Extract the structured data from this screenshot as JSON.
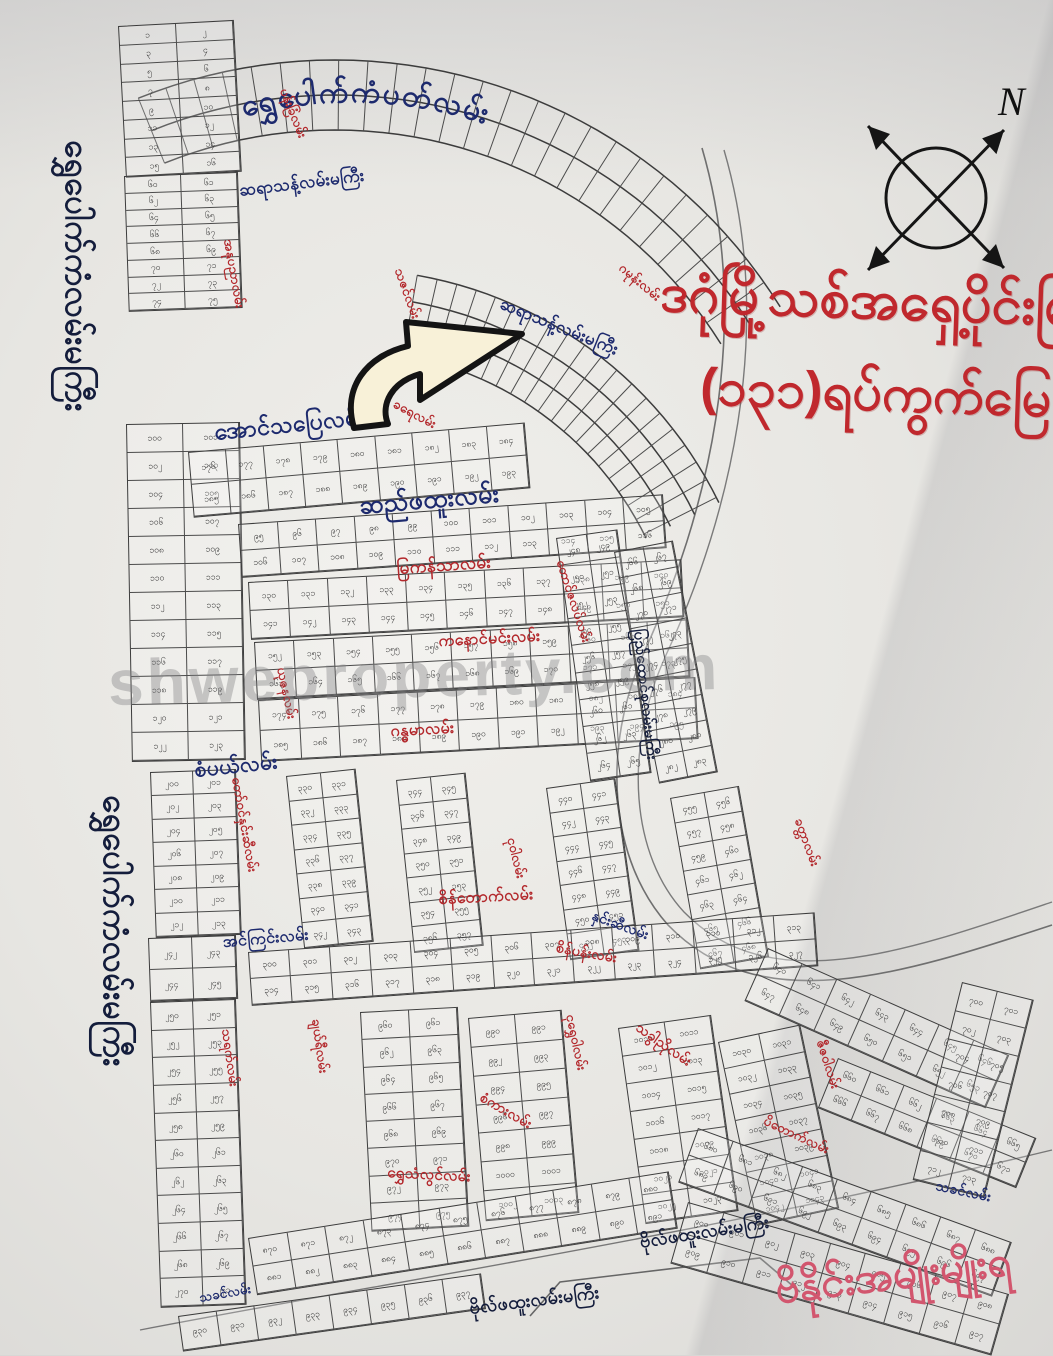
{
  "header": {
    "title_line1": "ဒဂုံမြို့သစ်အရှေ့ပိုင်းမြ",
    "title_line2": "(၁၃၁)ရပ်ကွက်မြေ",
    "compass_label": "N",
    "watermark": "shweproperty.com",
    "bottom_banner": "ဗိနိုင်းအမျိုးမျိုးရ"
  },
  "map": {
    "burmese_digits": "၀၁၂၃၄၅၆၇၈၉",
    "colors": {
      "street_navy": "#1d2a6e",
      "street_red": "#b3282c",
      "main_road_ink": "#141d3c",
      "title_red": "#c0282d",
      "banner_pink": "#d2566e",
      "plot_line": "#3c3c3c",
      "paper": "#efeeea"
    },
    "arc_title": {
      "text": "ရွှေပေါက်ကံပတ်လမ်း"
    },
    "street_labels": [
      {
        "text": "ဆရာသန့်လမ်းမကြီး",
        "x": 238,
        "y": 180,
        "rot": -7,
        "cls": "lbl-navy",
        "size": 17
      },
      {
        "text": "ဆရာသန့်လမ်းမကြီး",
        "x": 505,
        "y": 293,
        "rot": 22,
        "cls": "lbl-navy",
        "size": 17
      },
      {
        "text": "အောင်သပြေလမ်း",
        "x": 213,
        "y": 418,
        "rot": -6,
        "cls": "lbl-navy",
        "size": 23
      },
      {
        "text": "ဆည်ဖထူးလမ်း",
        "x": 358,
        "y": 490,
        "rot": -5,
        "cls": "lbl-navy",
        "size": 25
      },
      {
        "text": "စံပယ်လမ်း",
        "x": 193,
        "y": 757,
        "rot": -6,
        "cls": "lbl-navy",
        "size": 21
      },
      {
        "text": "အင်ကြင်းလမ်း",
        "x": 222,
        "y": 931,
        "rot": -5,
        "cls": "lbl-navy",
        "size": 16
      },
      {
        "text": "ပြည်ထောင်စုလမ်းမကြီး",
        "x": 648,
        "y": 628,
        "rot": 84,
        "cls": "lbl-ink",
        "size": 15
      },
      {
        "text": "နှင်းဆီလမ်း",
        "x": 596,
        "y": 906,
        "rot": 20,
        "cls": "lbl-navy",
        "size": 14
      },
      {
        "text": "သခင်လမ်း",
        "x": 938,
        "y": 1176,
        "rot": 12,
        "cls": "lbl-navy",
        "size": 14
      },
      {
        "text": "သခင်လမ်း",
        "x": 198,
        "y": 1290,
        "rot": -10,
        "cls": "lbl-navy",
        "size": 13
      },
      {
        "text": "ဗိုလ်ဖထူးလမ်းမကြီး",
        "x": 638,
        "y": 1230,
        "rot": -9,
        "cls": "lbl-ink",
        "size": 18
      },
      {
        "text": "ဗိုလ်ဖထူးလမ်းမကြီး",
        "x": 468,
        "y": 1296,
        "rot": -7,
        "cls": "lbl-ink",
        "size": 18
      },
      {
        "text": "ရွှေပေါက်ကံလမ်းမကြီး",
        "x": 98,
        "y": 140,
        "rot": 90,
        "cls": "lbl-ink",
        "size": 33
      },
      {
        "text": "ရွှေပေါက်ကံလမ်းမကြီး",
        "x": 136,
        "y": 795,
        "rot": 90,
        "cls": "lbl-ink",
        "size": 33
      },
      {
        "text": "ပန်းခြံလမ်း",
        "x": 291,
        "y": 86,
        "rot": 68,
        "cls": "lbl-red",
        "size": 13
      },
      {
        "text": "အနုပညာလမ်း",
        "x": 236,
        "y": 238,
        "rot": 80,
        "cls": "lbl-red",
        "size": 13
      },
      {
        "text": "သဇင်လမ်း",
        "x": 406,
        "y": 266,
        "rot": 70,
        "cls": "lbl-red",
        "size": 13
      },
      {
        "text": "ခရေလမ်း",
        "x": 398,
        "y": 396,
        "rot": 28,
        "cls": "lbl-red",
        "size": 13
      },
      {
        "text": "ဂမုန်းလမ်း",
        "x": 626,
        "y": 260,
        "rot": 40,
        "cls": "lbl-red",
        "size": 13
      },
      {
        "text": "မြကန်သာလမ်း",
        "x": 396,
        "y": 558,
        "rot": -4,
        "cls": "lbl-red",
        "size": 17
      },
      {
        "text": "ကနောင်မင်းလမ်း",
        "x": 438,
        "y": 630,
        "rot": -3,
        "cls": "lbl-red",
        "size": 16
      },
      {
        "text": "ဂန္ဓမာလမ်း",
        "x": 390,
        "y": 720,
        "rot": -3,
        "cls": "lbl-red",
        "size": 16
      },
      {
        "text": "ယုဇနလမ်း",
        "x": 289,
        "y": 666,
        "rot": 78,
        "cls": "lbl-red",
        "size": 13
      },
      {
        "text": "တော်ဝင်နှင်းဆီလမ်း",
        "x": 244,
        "y": 776,
        "rot": 80,
        "cls": "lbl-red",
        "size": 13
      },
      {
        "text": "တောင်ဇလပ်လမ်း",
        "x": 568,
        "y": 558,
        "rot": 72,
        "cls": "lbl-red",
        "size": 13
      },
      {
        "text": "ငုဝါလမ်း",
        "x": 519,
        "y": 836,
        "rot": 76,
        "cls": "lbl-red",
        "size": 13
      },
      {
        "text": "ခတ္တာလမ်း",
        "x": 806,
        "y": 816,
        "rot": 70,
        "cls": "lbl-red",
        "size": 13
      },
      {
        "text": "စိန်တောက်လမ်း",
        "x": 438,
        "y": 888,
        "rot": -3,
        "cls": "lbl-red",
        "size": 16
      },
      {
        "text": "စိန်ပန်းလမ်း",
        "x": 558,
        "y": 938,
        "rot": 10,
        "cls": "lbl-red",
        "size": 14
      },
      {
        "text": "သရက်လမ်း",
        "x": 234,
        "y": 1028,
        "rot": 82,
        "cls": "lbl-red",
        "size": 13
      },
      {
        "text": "ချယ်ရီလမ်း",
        "x": 324,
        "y": 1018,
        "rot": 82,
        "cls": "lbl-red",
        "size": 13
      },
      {
        "text": "ငုရွှေဝါလမ်း",
        "x": 578,
        "y": 1013,
        "rot": 78,
        "cls": "lbl-red",
        "size": 13
      },
      {
        "text": "ဇီဇဝါလမ်း",
        "x": 828,
        "y": 1038,
        "rot": 72,
        "cls": "lbl-red",
        "size": 13
      },
      {
        "text": "ရွှေသံလွင်လမ်း",
        "x": 388,
        "y": 1163,
        "rot": 3,
        "cls": "lbl-red",
        "size": 15
      },
      {
        "text": "သခွါညိုလမ်း",
        "x": 643,
        "y": 1018,
        "rot": 35,
        "cls": "lbl-red",
        "size": 14
      },
      {
        "text": "စံကားလမ်း",
        "x": 486,
        "y": 1088,
        "rot": 30,
        "cls": "lbl-red",
        "size": 14
      },
      {
        "text": "ပိတောက်လမ်း",
        "x": 768,
        "y": 1113,
        "rot": 25,
        "cls": "lbl-red",
        "size": 13
      }
    ],
    "blocks": [
      {
        "x": 118,
        "y": 26,
        "w": 114,
        "h": 150,
        "rot": -3,
        "r": 8,
        "c": 2,
        "start": 1
      },
      {
        "x": 124,
        "y": 176,
        "w": 112,
        "h": 134,
        "rot": -2,
        "r": 8,
        "c": 2,
        "start": 60
      },
      {
        "x": 126,
        "y": 424,
        "w": 112,
        "h": 336,
        "rot": -1,
        "r": 12,
        "c": 2,
        "start": 100
      },
      {
        "x": 188,
        "y": 452,
        "w": 336,
        "h": 64,
        "rot": -5,
        "r": 2,
        "c": 9,
        "start": 176
      },
      {
        "x": 238,
        "y": 524,
        "w": 424,
        "h": 52,
        "rot": -4,
        "r": 2,
        "c": 11,
        "start": 95
      },
      {
        "x": 248,
        "y": 582,
        "w": 432,
        "h": 56,
        "rot": -3,
        "r": 2,
        "c": 11,
        "start": 130
      },
      {
        "x": 254,
        "y": 642,
        "w": 432,
        "h": 56,
        "rot": -3,
        "r": 2,
        "c": 11,
        "start": 152
      },
      {
        "x": 258,
        "y": 700,
        "w": 436,
        "h": 60,
        "rot": -3,
        "r": 2,
        "c": 11,
        "start": 174
      },
      {
        "x": 556,
        "y": 538,
        "w": 60,
        "h": 244,
        "rot": -8,
        "r": 9,
        "c": 2,
        "start": 248
      },
      {
        "x": 614,
        "y": 552,
        "w": 58,
        "h": 234,
        "rot": -11,
        "r": 9,
        "c": 2,
        "start": 266
      },
      {
        "x": 150,
        "y": 772,
        "w": 84,
        "h": 164,
        "rot": -2,
        "r": 7,
        "c": 2,
        "start": 200
      },
      {
        "x": 148,
        "y": 938,
        "w": 86,
        "h": 62,
        "rot": -2,
        "r": 2,
        "c": 2,
        "start": 242
      },
      {
        "x": 150,
        "y": 1002,
        "w": 84,
        "h": 304,
        "rot": -2,
        "r": 11,
        "c": 2,
        "start": 250
      },
      {
        "x": 286,
        "y": 776,
        "w": 68,
        "h": 172,
        "rot": -6,
        "r": 7,
        "c": 2,
        "start": 330
      },
      {
        "x": 396,
        "y": 780,
        "w": 68,
        "h": 172,
        "rot": -6,
        "r": 7,
        "c": 2,
        "start": 344
      },
      {
        "x": 546,
        "y": 788,
        "w": 68,
        "h": 172,
        "rot": -8,
        "r": 7,
        "c": 2,
        "start": 440
      },
      {
        "x": 670,
        "y": 798,
        "w": 68,
        "h": 172,
        "rot": -10,
        "r": 7,
        "c": 2,
        "start": 455
      },
      {
        "x": 248,
        "y": 952,
        "w": 566,
        "h": 52,
        "rot": -4,
        "r": 2,
        "c": 14,
        "start": 300
      },
      {
        "x": 360,
        "y": 1012,
        "w": 96,
        "h": 218,
        "rot": -3,
        "r": 8,
        "c": 2,
        "start": 960
      },
      {
        "x": 468,
        "y": 1018,
        "w": 92,
        "h": 202,
        "rot": -5,
        "r": 7,
        "c": 2,
        "start": 990
      },
      {
        "x": 618,
        "y": 1028,
        "w": 92,
        "h": 196,
        "rot": -8,
        "r": 7,
        "c": 2,
        "start": 1010
      },
      {
        "x": 718,
        "y": 1042,
        "w": 82,
        "h": 186,
        "rot": -12,
        "r": 7,
        "c": 2,
        "start": 1030
      },
      {
        "x": 768,
        "y": 948,
        "w": 262,
        "h": 56,
        "rot": 24,
        "r": 2,
        "c": 7,
        "start": 640
      },
      {
        "x": 838,
        "y": 1058,
        "w": 212,
        "h": 52,
        "rot": 22,
        "r": 2,
        "c": 6,
        "start": 660
      },
      {
        "x": 698,
        "y": 1128,
        "w": 332,
        "h": 56,
        "rot": 20,
        "r": 2,
        "c": 9,
        "start": 680
      },
      {
        "x": 962,
        "y": 982,
        "w": 72,
        "h": 202,
        "rot": 14,
        "r": 7,
        "c": 2,
        "start": 700
      },
      {
        "x": 248,
        "y": 1238,
        "w": 424,
        "h": 56,
        "rot": -9,
        "r": 2,
        "c": 11,
        "start": 870
      },
      {
        "x": 688,
        "y": 1202,
        "w": 332,
        "h": 62,
        "rot": 16,
        "r": 2,
        "c": 9,
        "start": 900
      },
      {
        "x": 178,
        "y": 1316,
        "w": 304,
        "h": 34,
        "rot": -8,
        "r": 1,
        "c": 8,
        "start": 930
      }
    ]
  }
}
